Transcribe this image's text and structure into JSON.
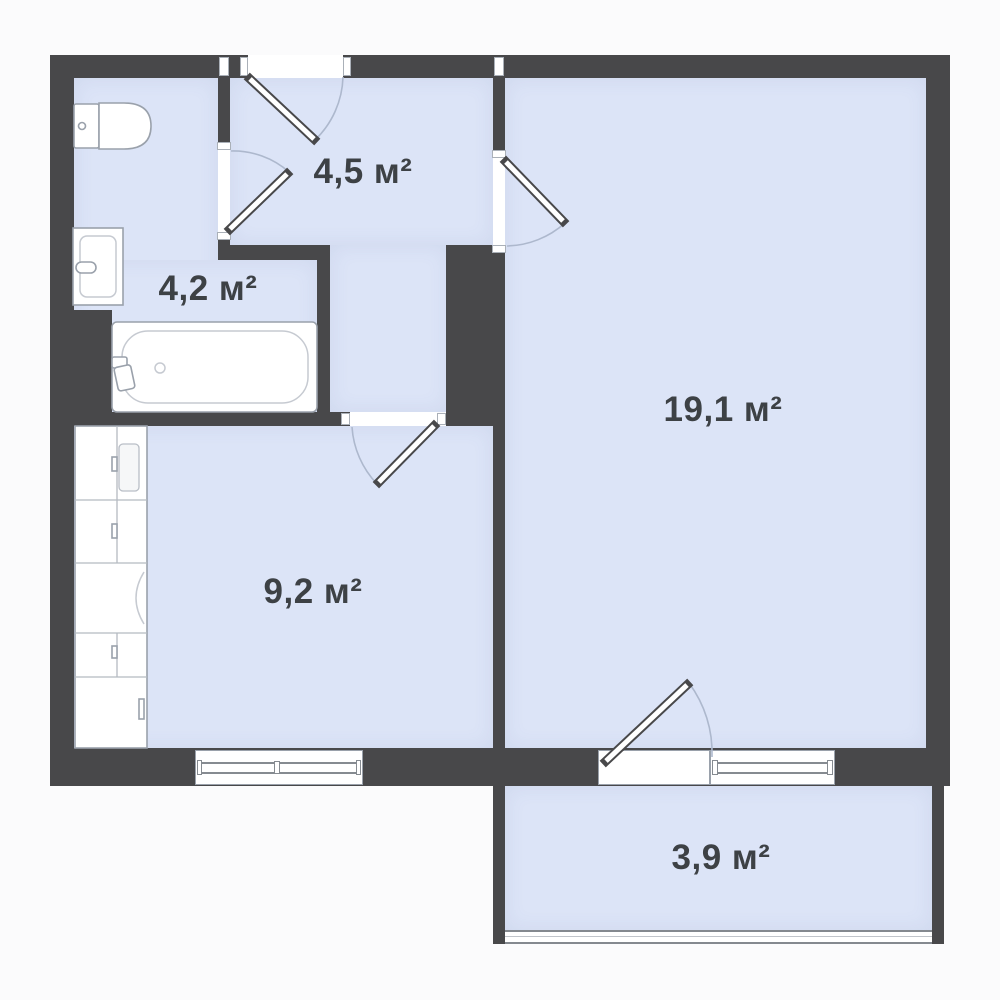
{
  "canvas": {
    "width": 1000,
    "height": 1000
  },
  "colors": {
    "wall": "#48484a",
    "room": "#dce4f7",
    "background": "#fbfbfc",
    "label": "#3d4145",
    "fixture_stroke": "#9aa1ab",
    "arc": "#adb8cd"
  },
  "rooms": {
    "hallway": {
      "label": "4,5 м²",
      "area_m2": 4.5
    },
    "bathroom": {
      "label": "4,2 м²",
      "area_m2": 4.2
    },
    "living": {
      "label": "19,1 м²",
      "area_m2": 19.1
    },
    "kitchen": {
      "label": "9,2 м²",
      "area_m2": 9.2
    },
    "balcony": {
      "label": "3,9 м²",
      "area_m2": 3.9
    }
  },
  "fixtures": [
    "toilet",
    "sink",
    "bathtub",
    "kitchen-counter"
  ],
  "openings": {
    "doors": [
      "entrance-door",
      "bathroom-door",
      "living-room-door",
      "kitchen-door",
      "balcony-door"
    ],
    "windows": [
      "kitchen-window",
      "balcony-window",
      "balcony-glazing"
    ]
  }
}
